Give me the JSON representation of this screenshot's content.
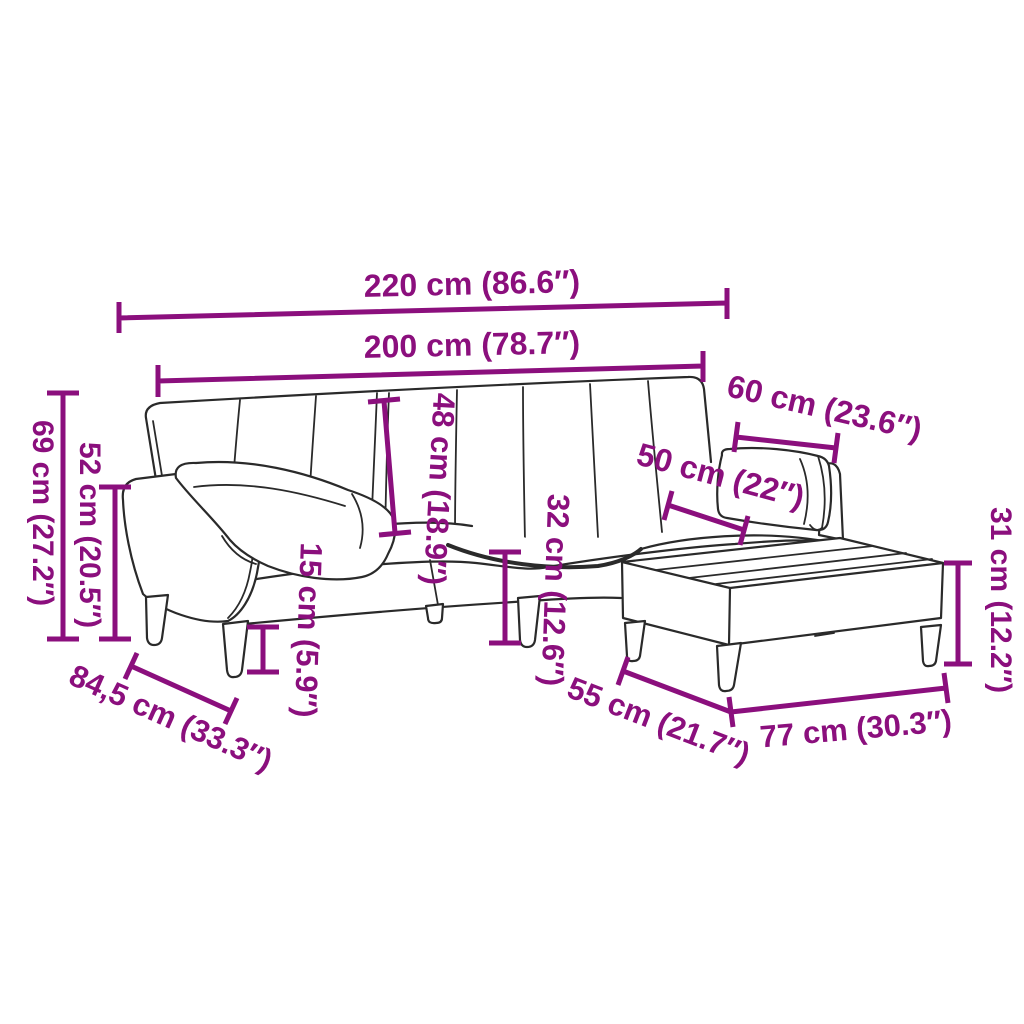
{
  "page": {
    "description": "Dimension diagram of a sofa bed with armrest cushion, right pillow and footstool",
    "background": "#ffffff"
  },
  "colors": {
    "accent": "#8B0F7D",
    "outline": "#2a2a2a"
  },
  "labels": {
    "overall_width": "220 cm (86.6″)",
    "inner_width": "200 cm (78.7″)",
    "overall_height": "69 cm (27.2″)",
    "armrest_height": "52 cm (20.5″)",
    "backrest_height": "48 cm (18.9″)",
    "leg_height": "15 cm (5.9″)",
    "seat_height": "32 cm (12.6″)",
    "seat_depth": "50 cm (22″)",
    "pillow_width": "60 cm (23.6″)",
    "footstool_height": "31 cm (12.2″)",
    "overall_depth": "84,5 cm (33.3″)",
    "footstool_depth": "55 cm (21.7″)",
    "footstool_width": "77 cm (30.3″)"
  }
}
